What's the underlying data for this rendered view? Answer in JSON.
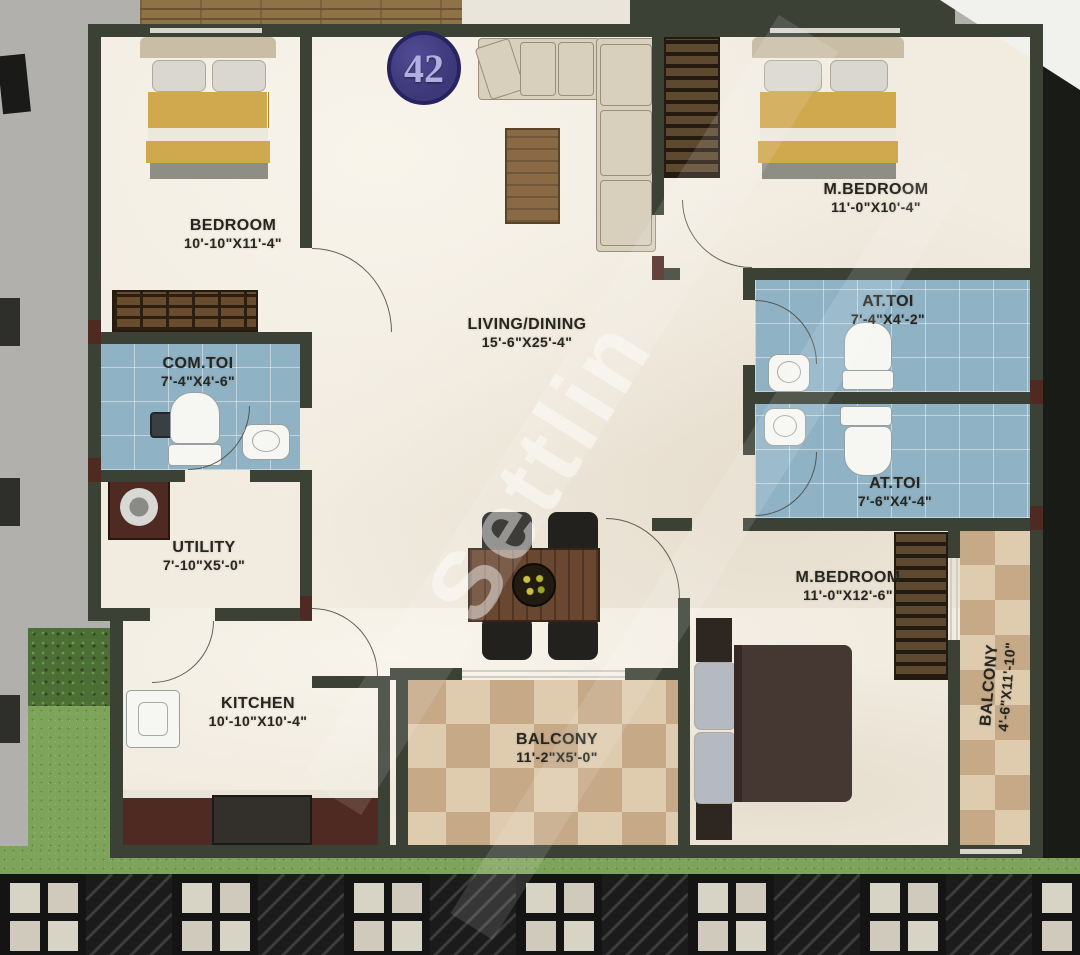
{
  "unit": {
    "number": "42"
  },
  "watermark": "Settlin",
  "rooms": {
    "bedroom": {
      "name": "BEDROOM",
      "dims": "10'-10\"X11'-4\""
    },
    "living": {
      "name": "LIVING/DINING",
      "dims": "15'-6\"X25'-4\""
    },
    "mbedroom_top": {
      "name": "M.BEDROOM",
      "dims": "11'-0\"X10'-4\""
    },
    "com_toi": {
      "name": "COM.TOI",
      "dims": "7'-4\"X4'-6\""
    },
    "at_toi_top": {
      "name": "AT.TOI",
      "dims": "7'-4\"X4'-2\""
    },
    "at_toi_bottom": {
      "name": "AT.TOI",
      "dims": "7'-6\"X4'-4\""
    },
    "utility": {
      "name": "UTILITY",
      "dims": "7'-10\"X5'-0\""
    },
    "kitchen": {
      "name": "KITCHEN",
      "dims": "10'-10\"X10'-4\""
    },
    "mbedroom_bottom": {
      "name": "M.BEDROOM",
      "dims": "11'-0\"X12'-6\""
    },
    "balcony_bottom": {
      "name": "BALCONY",
      "dims": "11'-2\"X5'-0\""
    },
    "balcony_right": {
      "name": "BALCONY",
      "dims": "4'-6\"X11'-10\""
    }
  },
  "palette": {
    "wall": "#3c4136",
    "floor": "#f1ebe0",
    "toilet_floor": "#8fb2c5",
    "balcony_tile": "#d3b897",
    "badge_bg": "#3d3878",
    "badge_text": "#b3aee0",
    "bed_gold": "#d0a84e",
    "counter_red": "#4e2a22",
    "paving_dark": "#141414",
    "paving_light": "#d7d3c5",
    "grass_green": "#7ea35a"
  }
}
